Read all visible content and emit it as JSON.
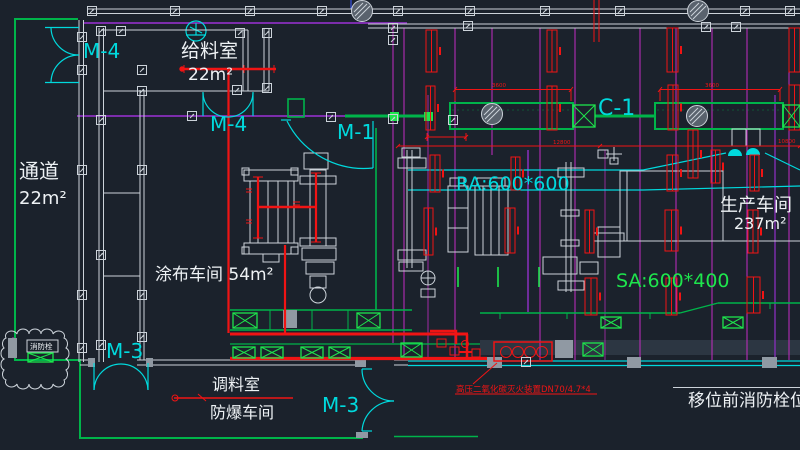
{
  "meta": {
    "drawing_type": "factory fire-protection floor plan (CAD)"
  },
  "colors": {
    "bg": "#1b222c",
    "wall": "#ccd3da",
    "green": "#00b44a",
    "lime": "#1ee54d",
    "cyan": "#00d9dd",
    "magenta": "#c32cc3",
    "purple": "#8a2fbe",
    "red": "#f01414",
    "gray": "#9099a3",
    "ink": "#eef2f5"
  },
  "symbols": {
    "column_marker": "small-square-anchor",
    "hatched_column": "hatched-circle",
    "diffuser": "rect-with-x",
    "door": "quarter-arc-pair",
    "dome_light": "half-dome",
    "fan": "circle-fan",
    "revision_cloud": "scalloped-cloud"
  },
  "labels": {
    "door_m4_top": "M-4",
    "door_m4_mid": "M-4",
    "door_m1": "M-1",
    "door_m3_left": "M-3",
    "door_m3_mid": "M-3",
    "grid_c1": "C-1",
    "room_feed": "给料室",
    "room_feed_area": "22m²",
    "room_corridor": "通道",
    "room_corridor_area": "22m²",
    "room_coating": "涂布车间 54m²",
    "room_production": "生产车间",
    "room_production_area": "237m²",
    "duct_ra": "RA:600*600",
    "duct_sa": "SA:600*400",
    "room_mixing": "调料室",
    "room_explosion": "防爆车间",
    "note_co2": "高压二氧化碳灭火装置DN70/4.7*4",
    "note_hydrant": "移位前消防栓位置",
    "cloud_hydrant": "消防栓",
    "dim_duct1": "3600",
    "dim_duct2": "3600",
    "dim_span1": "12800",
    "dim_span2": "10800"
  }
}
